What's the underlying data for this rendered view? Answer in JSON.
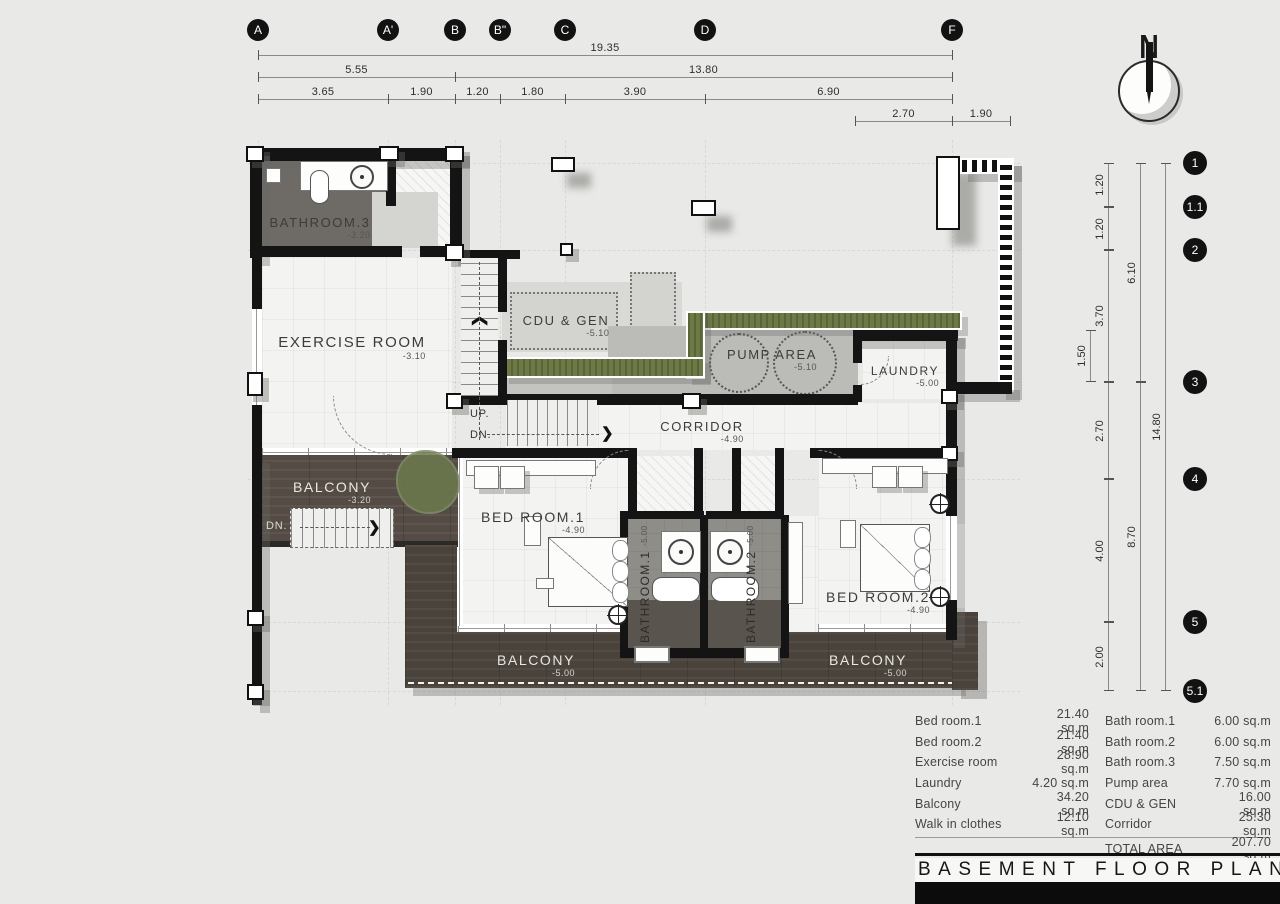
{
  "grid": {
    "top": [
      "A",
      "A'",
      "B",
      "B\"",
      "C",
      "D",
      "F"
    ],
    "right": [
      "1",
      "1.1",
      "2",
      "3",
      "4",
      "5",
      "5.1"
    ]
  },
  "dims": {
    "top_total": "19.35",
    "row2": [
      "5.55",
      "13.80"
    ],
    "row3": [
      "3.65",
      "1.90",
      "1.20",
      "1.80",
      "3.90",
      "6.90"
    ],
    "row4": [
      "2.70",
      "1.90"
    ],
    "right_segments": [
      "1.20",
      "1.20",
      "3.70",
      "2.70",
      "4.00",
      "2.00"
    ],
    "right_sub": "1.50",
    "right_mid": [
      "6.10",
      "8.70"
    ],
    "right_total": "14.80"
  },
  "north": {
    "label": "N"
  },
  "rooms": {
    "bathroom3": {
      "name": "BATHROOM.3",
      "elev": "-3.20"
    },
    "exercise": {
      "name": "EXERCISE ROOM",
      "elev": "-3.10"
    },
    "cdu": {
      "name": "CDU & GEN",
      "elev": "-5.10"
    },
    "pump": {
      "name": "PUMP AREA",
      "elev": "-5.10"
    },
    "laundry": {
      "name": "LAUNDRY",
      "elev": "-5.00"
    },
    "corridor": {
      "name": "CORRIDOR",
      "elev": "-4.90"
    },
    "bedroom1": {
      "name": "BED ROOM.1",
      "elev": "-4.90"
    },
    "bathroom1": {
      "name": "BATHROOM.1",
      "elev": "-5.00"
    },
    "bathroom2": {
      "name": "BATHROOM.2",
      "elev": "-5.00"
    },
    "bedroom2": {
      "name": "BED ROOM.2",
      "elev": "-4.90"
    },
    "balcony_left": {
      "name": "BALCONY",
      "elev": "-3.20"
    },
    "balcony_center": {
      "name": "BALCONY",
      "elev": "-5.00"
    },
    "balcony_right": {
      "name": "BALCONY",
      "elev": "-5.00"
    }
  },
  "stairs": {
    "up": "UP.",
    "dn": "DN.",
    "dn_balcony": "DN."
  },
  "table": {
    "rows": [
      {
        "l_label": "Bed room.1",
        "l_value": "21.40 sq.m",
        "r_label": "Bath room.1",
        "r_value": "6.00 sq.m"
      },
      {
        "l_label": "Bed room.2",
        "l_value": "21.40 sq.m",
        "r_label": "Bath room.2",
        "r_value": "6.00 sq.m"
      },
      {
        "l_label": "Exercise room",
        "l_value": "28.90 sq.m",
        "r_label": "Bath room.3",
        "r_value": "7.50 sq.m"
      },
      {
        "l_label": "Laundry",
        "l_value": "4.20 sq.m",
        "r_label": "Pump area",
        "r_value": "7.70 sq.m"
      },
      {
        "l_label": "Balcony",
        "l_value": "34.20 sq.m",
        "r_label": "CDU & GEN",
        "r_value": "16.00 sq.m"
      },
      {
        "l_label": "Walk in clothes",
        "l_value": "12.10 sq.m",
        "r_label": "Corridor",
        "r_value": "25.30 sq.m"
      }
    ],
    "total_label": "TOTAL AREA",
    "total_value": "207.70 sq.m"
  },
  "title": "BASEMENT FLOOR PLAN",
  "colors": {
    "wall": "#141414",
    "wood": "#4a433c",
    "planter": "#6d7a45",
    "tile": "#f3f3f1",
    "concrete": "#bbbbb8",
    "background": "#e9e9e7"
  }
}
